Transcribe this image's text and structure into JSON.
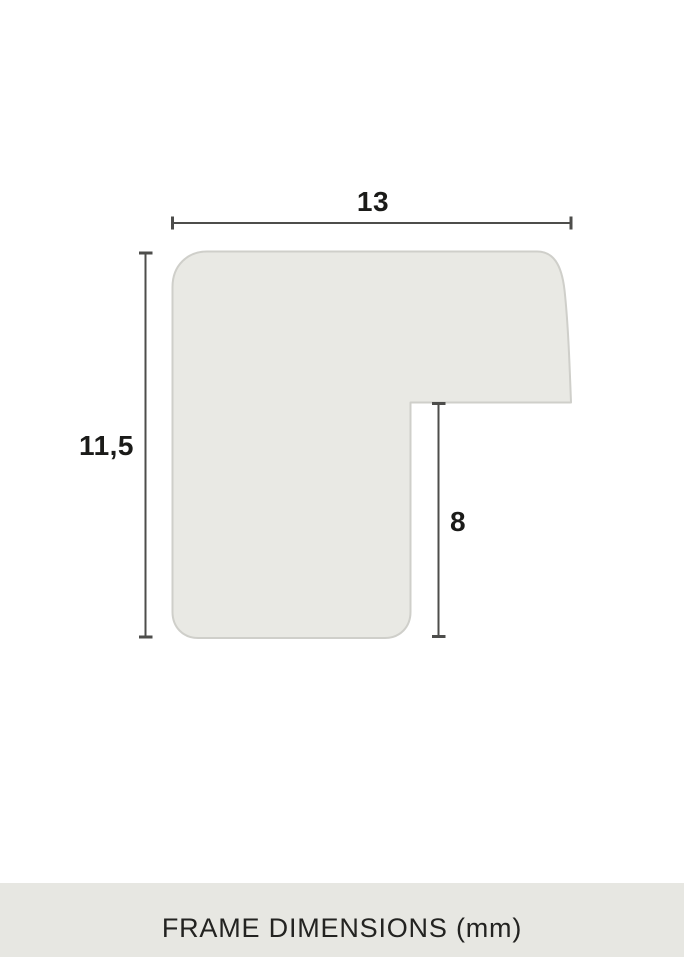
{
  "diagram": {
    "title": "frame-moulding-profile-cross-section",
    "labels": {
      "width": "13",
      "height": "11,5",
      "rabbet": "8"
    },
    "units": "mm",
    "colors": {
      "shape_fill": "#e9e9e4",
      "shape_stroke": "#cfcfca",
      "dimension_line": "#4d4d4b",
      "label_text": "#1b1b19"
    }
  },
  "footer": {
    "caption": "FRAME DIMENSIONS (mm)",
    "background": "#e7e7e2",
    "text_color": "#232321"
  }
}
